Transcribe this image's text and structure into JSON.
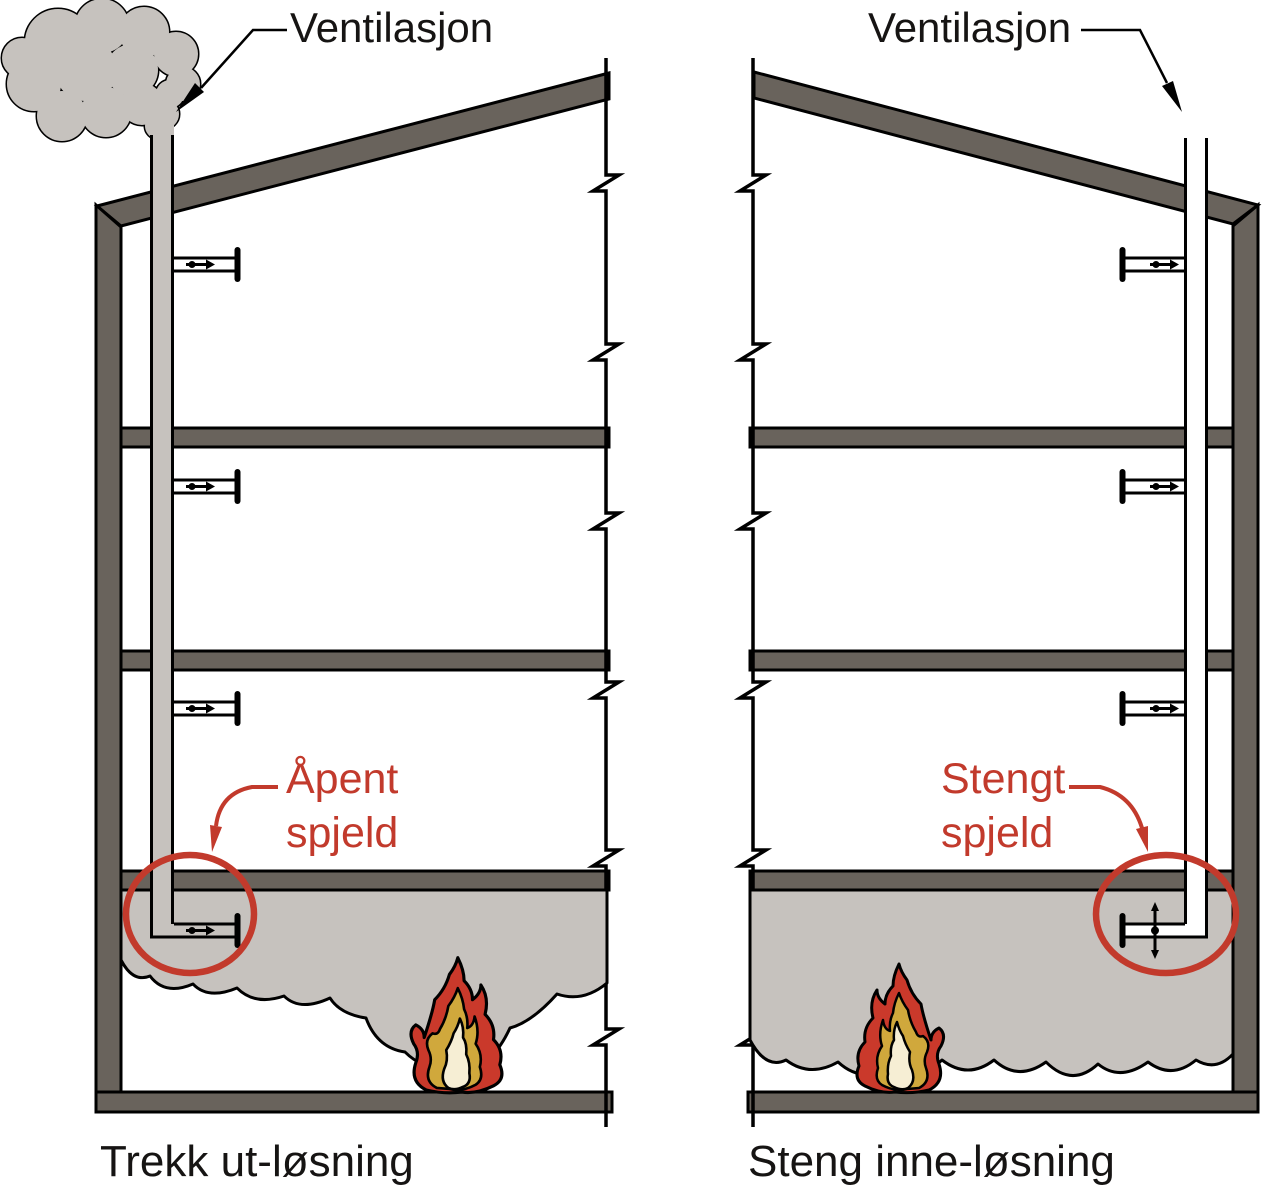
{
  "diagram": {
    "left_panel": {
      "ventilation_label": "Ventilasjon",
      "damper_label": {
        "line1": "Åpent",
        "line2": "spjeld"
      },
      "caption": "Trekk ut-løsning"
    },
    "right_panel": {
      "ventilation_label": "Ventilasjon",
      "damper_label": {
        "line1": "Stengt",
        "line2": "spjeld"
      },
      "caption": "Steng inne-løsning"
    },
    "icons": {
      "smoke_plume": "smoke-plume-icon",
      "fire": "flame-icon",
      "open_damper": "open-damper-symbol",
      "closed_damper": "closed-damper-symbol",
      "break_mark": "section-break-mark"
    },
    "colors": {
      "structure_dark": "#69635c",
      "smoke_gray": "#c6c2be",
      "annotation_red": "#c23a2c",
      "flame_outer": "#ca392b",
      "flame_mid": "#d0a83c",
      "flame_inner": "#f6eed4",
      "outline": "#000000",
      "background": "#ffffff"
    }
  }
}
